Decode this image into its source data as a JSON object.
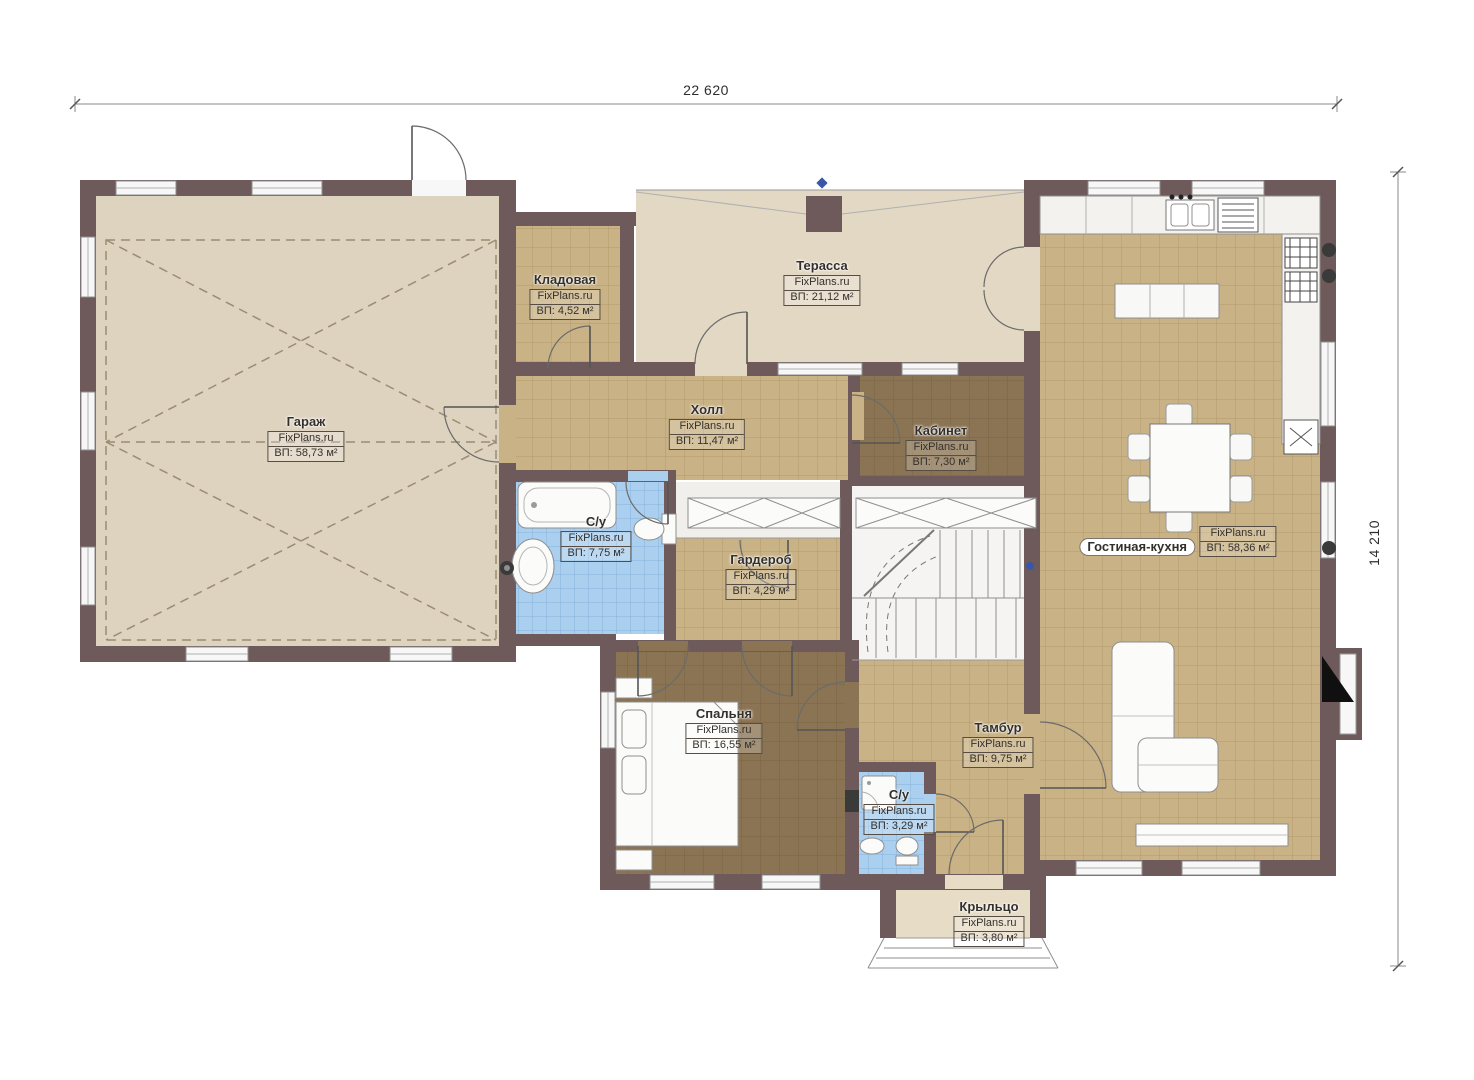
{
  "brand": "FixPlans.ru",
  "dimensions": {
    "width": "22 620",
    "height": "14 210"
  },
  "rooms": {
    "garage": {
      "name": "Гараж",
      "area": "ВП: 58,73 м²"
    },
    "storage": {
      "name": "Кладовая",
      "area": "ВП: 4,52 м²"
    },
    "terrace": {
      "name": "Терасса",
      "area": "ВП: 21,12 м²"
    },
    "hall": {
      "name": "Холл",
      "area": "ВП: 11,47 м²"
    },
    "office": {
      "name": "Кабинет",
      "area": "ВП: 7,30 м²"
    },
    "bathroom_main": {
      "name": "С/у",
      "area": "ВП: 7,75 м²"
    },
    "wardrobe": {
      "name": "Гардероб",
      "area": "ВП: 4,29 м²"
    },
    "living_kitchen": {
      "name": "Гостиная-кухня",
      "area": "ВП: 58,36 м²"
    },
    "bedroom": {
      "name": "Спальня",
      "area": "ВП: 16,55 м²"
    },
    "vestibule": {
      "name": "Тамбур",
      "area": "ВП: 9,75 м²"
    },
    "bathroom_small": {
      "name": "С/у",
      "area": "ВП: 3,29 м²"
    },
    "porch": {
      "name": "Крыльцо",
      "area": "ВП: 3,80 м²"
    }
  },
  "colors": {
    "wall": "#6e5a5a",
    "garage_floor": "#ded3bf",
    "terrace_floor": "#e3d8c4",
    "tile_tan": "#c9b285",
    "tile_dark": "#8b7453",
    "tile_blue": "#abcfee",
    "marker_blue": "#3a56a8"
  }
}
